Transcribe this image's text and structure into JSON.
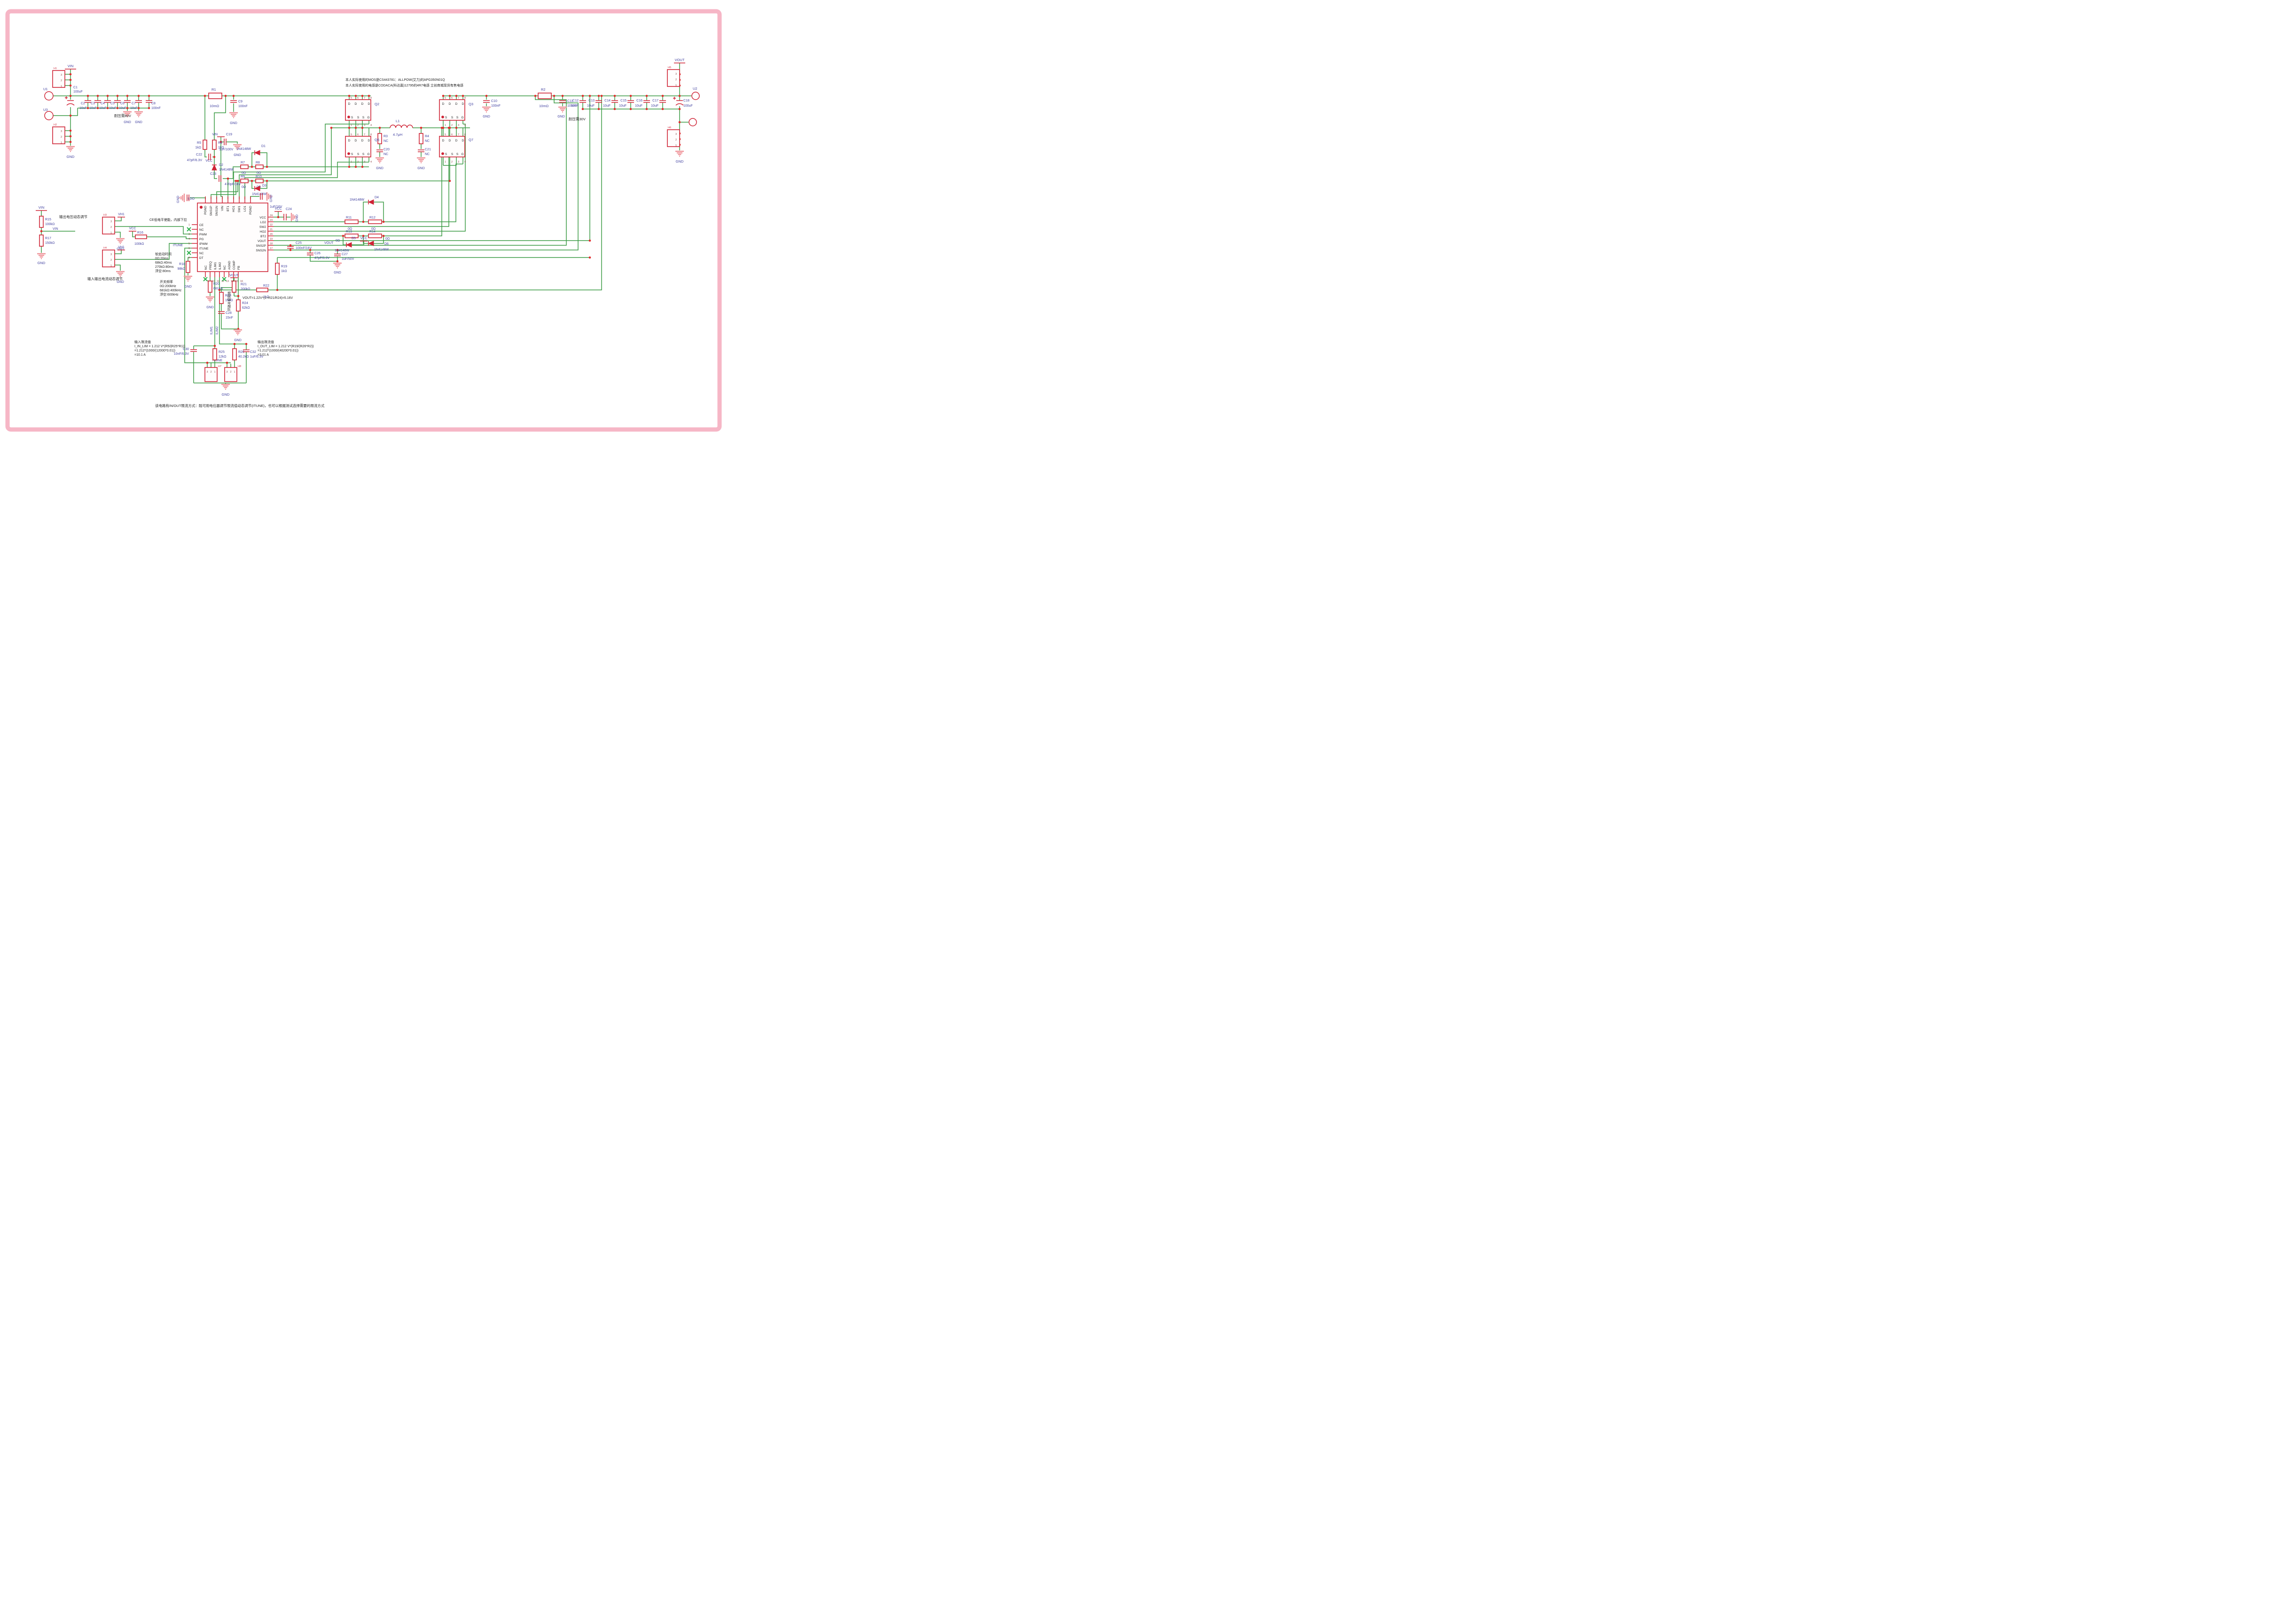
{
  "colors": {
    "wire": "#3a9a44",
    "component": "#cf2335",
    "label_blue": "#3f3f9f",
    "gnd": "#ef9298",
    "frame_pink": "#f6b6c6"
  },
  "t": {
    "gnd": "GND",
    "vin": "VIN",
    "vout": "VOUT",
    "vcc": "VCC",
    "itune": "ITUNE",
    "ldo": "LDO",
    "ilim1": "ILIM1",
    "ilim2": "ILIM2",
    "vh1": "VH1",
    "u1": "U1",
    "u2": "U2",
    "u3": "U3",
    "q2": "Q2",
    "q3": "Q3",
    "q6": "Q6",
    "q7": "Q7",
    "mos_note1": "本人实际使用的MOS是CS443781：ALLPOW(艾力)的APG350N01Q",
    "mos_note2": "本人实际使用的电感是CODACA(科达嘉)12795的4R7电感 立创商城现货有售电感",
    "note_v80": "耐压需80V",
    "note_v30": "耐压需30V",
    "ce_note": "CE低电平使能，内部下拉",
    "vout_adj": "输出电压动态调节",
    "cur_adj": "输入输出电流动态调节",
    "comp_note": "环路补偿网络",
    "formula": "VOUT=1.22V*(1+R21/R24)=5.16V",
    "bottom_note": "该电路有IN/OUT限流方式：既可用电位器调节限流值动态调节(ITUNE)，也可以根据测试选择需要的限流方式"
  },
  "arr": {
    "ss": [
      "软启动时间",
      "0Ω:20ms",
      "68kΩ:40ms",
      "270kΩ:80ms",
      "浮空:80ms"
    ],
    "freq": [
      "开关频率",
      "0Ω:200kHz",
      "681kΩ:400kHz",
      "浮空:600kHz"
    ],
    "inlim": [
      "输入限流值",
      "I_IN_LIM = 1.212 V*(R5/(R25*R1))",
      "=1.212*(1000/(12000*0.01))",
      "=10.1 A"
    ],
    "outlim": [
      "输出限流值",
      "I_OUT_LIM = 1.212 V*(R19/(R26*R2))",
      "=1.212*(1000/(40200*0.01))",
      "=3.01 A"
    ]
  },
  "p": {
    "r1": [
      "R1",
      "10mΩ"
    ],
    "r2": [
      "R2",
      "10mΩ"
    ],
    "r3": [
      "R3",
      "NC"
    ],
    "r4": [
      "R4",
      "NC"
    ],
    "r5": [
      "R5",
      "1kΩ"
    ],
    "r6": [
      "R6",
      "1kΩ"
    ],
    "r7": [
      "R7",
      "0Ω"
    ],
    "r8": [
      "R8",
      "0Ω"
    ],
    "r9": [
      "R9",
      "0Ω"
    ],
    "r10": [
      "R10",
      "0Ω"
    ],
    "r11": [
      "R11",
      "0Ω"
    ],
    "r12": [
      "R12",
      "0Ω"
    ],
    "r13": [
      "R13",
      "0Ω"
    ],
    "r14": [
      "R14",
      "0Ω"
    ],
    "r15": [
      "R15",
      "100kΩ"
    ],
    "r16": [
      "R16",
      "100kΩ"
    ],
    "r17": [
      "R17",
      "150kΩ"
    ],
    "r18": [
      "R18",
      "98kΩ"
    ],
    "r19": [
      "R19",
      "1kΩ"
    ],
    "r20": [
      "R20",
      "681kΩ"
    ],
    "r21": [
      "R21",
      "200kΩ"
    ],
    "r22": [
      "R22",
      "1kΩ"
    ],
    "r23": [
      "R23",
      "15kΩ"
    ],
    "r24": [
      "R24",
      "62kΩ"
    ],
    "r25": [
      "R25",
      "12kΩ"
    ],
    "r26": [
      "R26",
      "40.2kΩ"
    ],
    "c1": [
      "C1",
      "100uF"
    ],
    "c2": [
      "C2",
      "10uF"
    ],
    "c3": [
      "C3",
      "10uF"
    ],
    "c4": [
      "C4",
      "10uF"
    ],
    "c5": [
      "C5",
      "10uF"
    ],
    "c6": [
      "C6",
      "10uF"
    ],
    "c7": [
      "C7",
      "10uF"
    ],
    "c8": [
      "C8",
      "100nF"
    ],
    "c9": [
      "C9",
      "100nF"
    ],
    "c10": [
      "C10",
      "100nF"
    ],
    "c11": [
      "C11",
      "100nF"
    ],
    "c12": [
      "C12",
      "10uF"
    ],
    "c13": [
      "C13",
      "10uF"
    ],
    "c14": [
      "C14",
      "10uF"
    ],
    "c15": [
      "C15",
      "10uF"
    ],
    "c16": [
      "C16",
      "10uF"
    ],
    "c17": [
      "C17",
      "10uF"
    ],
    "c18": [
      "C18",
      "100uF"
    ],
    "c19": [
      "C19",
      "1uF/100V"
    ],
    "c20": [
      "C20",
      "NC"
    ],
    "c21": [
      "C21",
      "NC"
    ],
    "c22": [
      "C22",
      "47pF/6.3V"
    ],
    "c23": [
      "C23",
      "470pF/16V"
    ],
    "c24": [
      "C24",
      "1uF/16V"
    ],
    "c25": [
      "C25",
      "100nF/16V"
    ],
    "c26": [
      "C26",
      "47pF/6.3V"
    ],
    "c27": [
      "C27",
      "1uF/50V"
    ],
    "c28": [
      "C28",
      "15nF"
    ],
    "c30": [
      "C30",
      "10nF/6.3V"
    ],
    "c32": [
      "C32",
      "1uF/6.3V"
    ],
    "d1": [
      "D1",
      "1N4148W"
    ],
    "d2": [
      "D2",
      "1N4148W"
    ],
    "d3": [
      "D3",
      "1N4148W"
    ],
    "d4": [
      "D4",
      "1N4148W"
    ],
    "d5": [
      "D5",
      "1N4148W"
    ],
    "d6": [
      "D6",
      "1N4148W"
    ],
    "l1": [
      "L1",
      "4.7μH"
    ]
  },
  "ic": {
    "left": [
      {
        "n": "1",
        "l": "CE"
      },
      {
        "n": "2",
        "l": "NC"
      },
      {
        "n": "3",
        "l": "PWM"
      },
      {
        "n": "4",
        "l": "PG"
      },
      {
        "n": "5",
        "l": "IPWM"
      },
      {
        "n": "6",
        "l": "ITUNE"
      },
      {
        "n": "7",
        "l": "NC"
      },
      {
        "n": "8",
        "l": "DT"
      }
    ],
    "bottom": [
      {
        "n": "9",
        "l": "NC"
      },
      {
        "n": "10",
        "l": "FREQ"
      },
      {
        "n": "11",
        "l": "ILIM1"
      },
      {
        "n": "12",
        "l": "ILIM2"
      },
      {
        "n": "13",
        "l": "NC"
      },
      {
        "n": "14",
        "l": "AGND"
      },
      {
        "n": "15",
        "l": "COMP"
      },
      {
        "n": "16",
        "l": "FB"
      }
    ],
    "right": [
      {
        "n": "17",
        "l": "SNS2N"
      },
      {
        "n": "18",
        "l": "SNS2P"
      },
      {
        "n": "19",
        "l": "VOUT"
      },
      {
        "n": "20",
        "l": "BT2"
      },
      {
        "n": "21",
        "l": "HO2"
      },
      {
        "n": "22",
        "l": "SW2"
      },
      {
        "n": "23",
        "l": "LO2"
      },
      {
        "n": "24",
        "l": "VCC"
      }
    ],
    "top": [
      "PGND",
      "SNS1P",
      "SNS1N",
      "VIN",
      "BT1",
      "HO1",
      "SW1",
      "LO1",
      "PGND"
    ]
  },
  "mos": {
    "top": [
      "D",
      "D",
      "D",
      "D"
    ],
    "topn": [
      "5",
      "6",
      "7",
      "8"
    ],
    "bot": [
      "S",
      "S",
      "S",
      "G"
    ],
    "botn": [
      "1",
      "2",
      "3",
      "4"
    ]
  },
  "conn": {
    "nums": [
      "3",
      "2",
      "1"
    ],
    "refs": [
      "H1",
      "H2",
      "H3",
      "H4",
      "H5",
      "H6",
      "H7",
      "H8"
    ]
  }
}
